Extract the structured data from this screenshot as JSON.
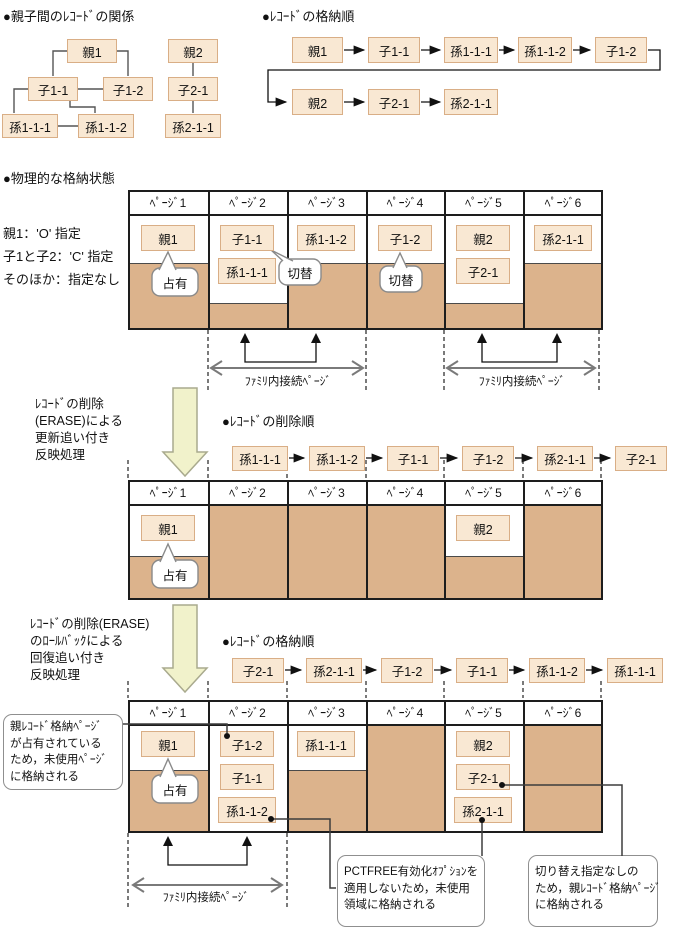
{
  "titles": {
    "relation": "●親子間のﾚｺｰﾄﾞの関係",
    "storage_order_top": "●ﾚｺｰﾄﾞの格納順",
    "physical_state": "●物理的な格納状態",
    "delete_order": "●ﾚｺｰﾄﾞの削除順",
    "storage_order_bottom": "●ﾚｺｰﾄﾞの格納順"
  },
  "records": {
    "oya1": "親1",
    "oya2": "親2",
    "ko11": "子1-1",
    "ko12": "子1-2",
    "ko21": "子2-1",
    "mago111": "孫1-1-1",
    "mago112": "孫1-1-2",
    "mago211": "孫2-1-1"
  },
  "pages": [
    "ﾍﾟｰｼﾞ1",
    "ﾍﾟｰｼﾞ2",
    "ﾍﾟｰｼﾞ3",
    "ﾍﾟｰｼﾞ4",
    "ﾍﾟｰｼﾞ5",
    "ﾍﾟｰｼﾞ6"
  ],
  "spec": [
    "親1：'O' 指定",
    "子1と子2：'C' 指定",
    "そのほか：指定なし"
  ],
  "balloons": {
    "occupied": "占有",
    "switch": "切替"
  },
  "family_label": "ﾌｧﾐﾘ内接続ﾍﾟｰｼﾞ",
  "process1": [
    "ﾚｺｰﾄﾞの削除",
    "(ERASE)による",
    "更新追い付き",
    "反映処理"
  ],
  "process2": [
    "ﾚｺｰﾄﾞの削除(ERASE)",
    "のﾛｰﾙﾊﾞｯｸによる",
    "回復追い付き",
    "反映処理"
  ],
  "sequences": {
    "storage_top_row1": [
      "親1",
      "子1-1",
      "孫1-1-1",
      "孫1-1-2",
      "子1-2"
    ],
    "storage_top_row2": [
      "親2",
      "子2-1",
      "孫2-1-1"
    ],
    "delete_order": [
      "孫1-1-1",
      "孫1-1-2",
      "子1-1",
      "子1-2",
      "孫2-1-1",
      "子2-1"
    ],
    "restore_order": [
      "子2-1",
      "孫2-1-1",
      "子1-2",
      "子1-1",
      "孫1-1-2",
      "孫1-1-1"
    ]
  },
  "callouts": {
    "occupied_page": [
      "親ﾚｺｰﾄﾞ格納ﾍﾟｰｼﾞ",
      "が占有されている",
      "ため，未使用ﾍﾟｰｼﾞ",
      "に格納される"
    ],
    "pctfree": [
      "PCTFREE有効化ｵﾌﾟｼｮﾝを",
      "適用しないため，未使用",
      "領域に格納される"
    ],
    "no_switch": [
      "切り替え指定なしの",
      "ため，親ﾚｺｰﾄﾞ格納ﾍﾟｰｼﾞ",
      "に格納される"
    ]
  },
  "colors": {
    "record_fill": "#f9e8d3",
    "record_border": "#d9ae86",
    "occupied_shade": "#dcb38c",
    "process_arrow_fill": "#f1f2cb",
    "line": "#1d1d1d",
    "gray_arrow": "#7a7a7a"
  }
}
